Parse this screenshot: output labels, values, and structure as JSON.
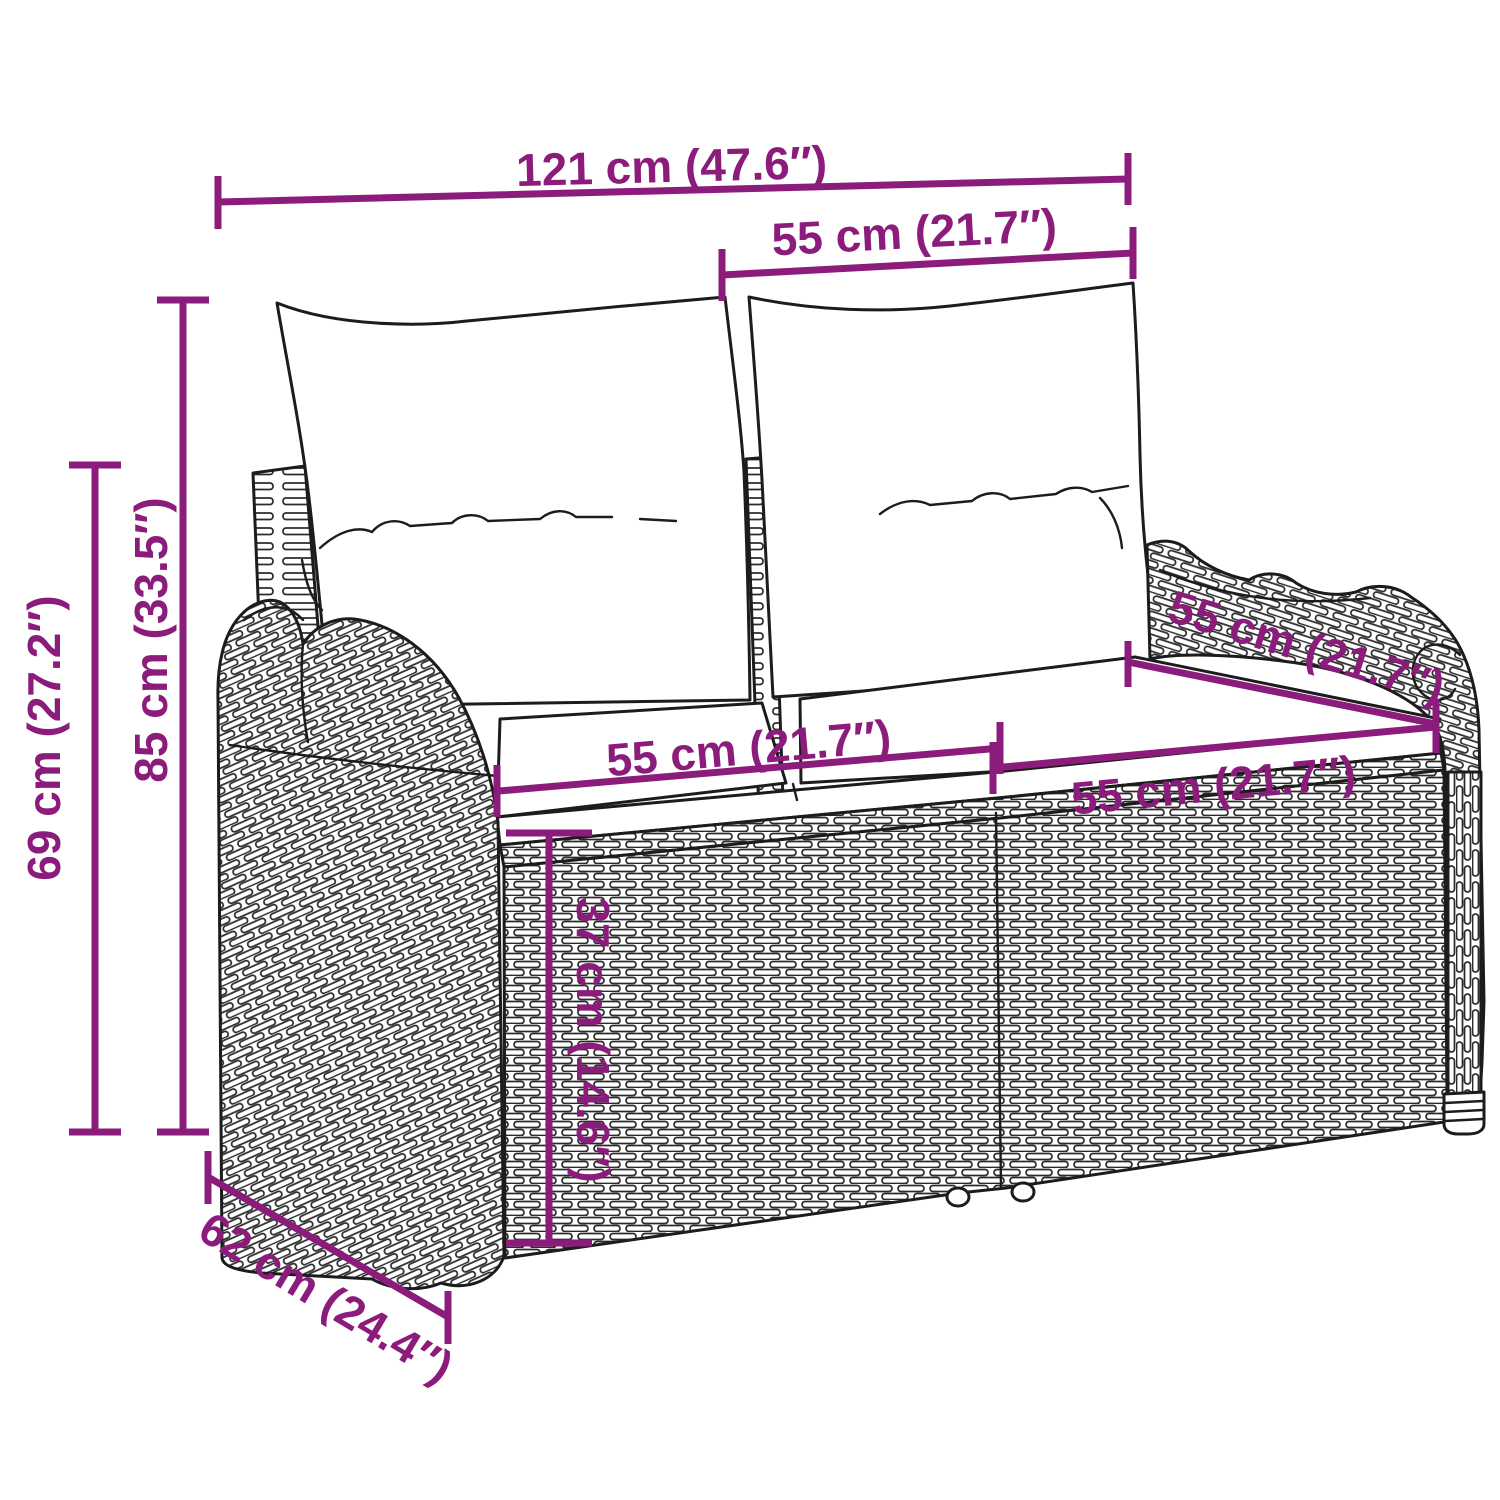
{
  "diagram": {
    "kind": "product-dimension-diagram",
    "subject": "poly-rattan 2-seater garden bench with back and seat cushions",
    "background_color": "#ffffff",
    "lineart_color": "#1c1c1c",
    "accent_color": "#8C1C7C",
    "dimensions": [
      {
        "id": "overall-width",
        "label": "121 cm (47.6″)",
        "value_cm": 121,
        "value_in": 47.6
      },
      {
        "id": "back-cushion-width",
        "label": "55 cm (21.7″)",
        "value_cm": 55,
        "value_in": 21.7
      },
      {
        "id": "total-height",
        "label": "85 cm (33.5″)",
        "value_cm": 85,
        "value_in": 33.5
      },
      {
        "id": "frame-height",
        "label": "69 cm (27.2″)",
        "value_cm": 69,
        "value_in": 27.2
      },
      {
        "id": "seat-width-left",
        "label": "55 cm (21.7″)",
        "value_cm": 55,
        "value_in": 21.7
      },
      {
        "id": "seat-width-right",
        "label": "55 cm (21.7″)",
        "value_cm": 55,
        "value_in": 21.7
      },
      {
        "id": "seat-depth",
        "label": "55 cm (21.7″)",
        "value_cm": 55,
        "value_in": 21.7
      },
      {
        "id": "seat-height",
        "label": "37 cm (14.6″)",
        "value_cm": 37,
        "value_in": 14.6
      },
      {
        "id": "overall-depth",
        "label": "62 cm (24.4″)",
        "value_cm": 62,
        "value_in": 24.4
      }
    ]
  }
}
